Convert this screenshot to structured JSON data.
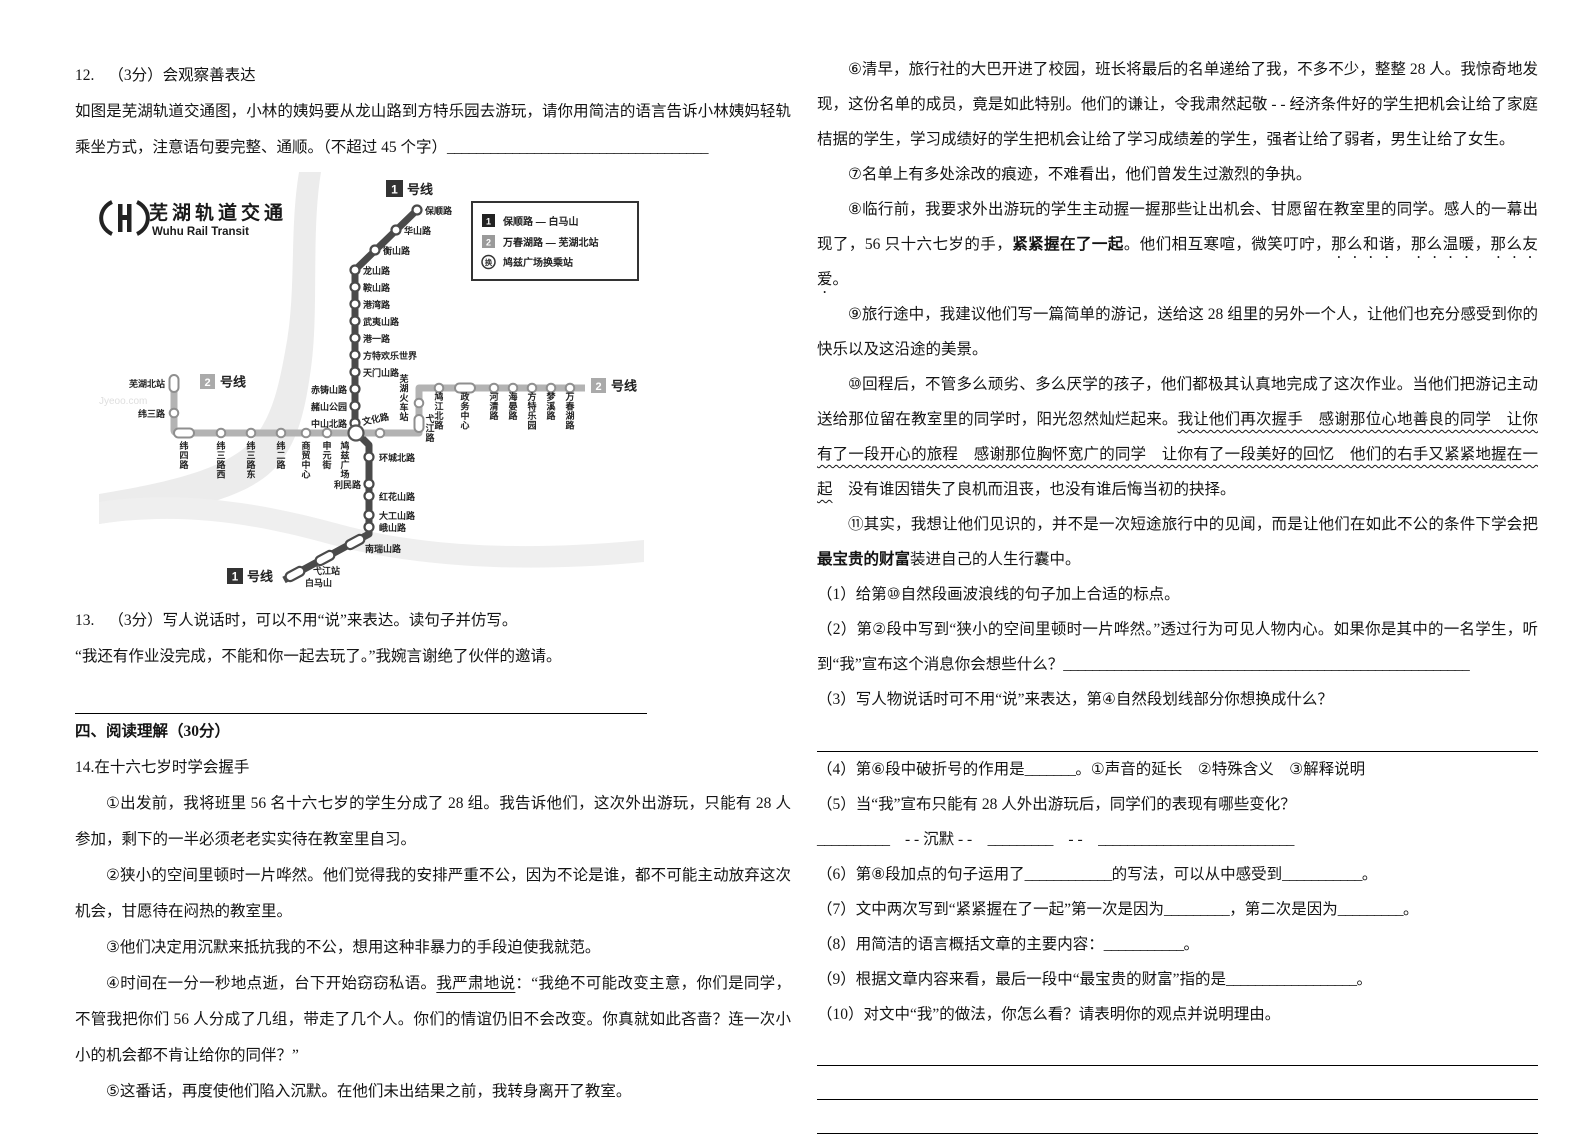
{
  "q12": {
    "label": "12.",
    "score": "（3分）",
    "title": "会观察善表达",
    "body": [
      {
        "t": "如图是芜湖轨道交通图，小林的姨妈要从龙山路到方特乐园去游玩，请你用简洁的语言告诉小林姨妈轻轨乘坐方式，注意语句要完整、通顺。（不超过 45 个字）"
      },
      {
        "t": "____________________________________",
        "s": "blank"
      }
    ]
  },
  "map": {
    "logo": {
      "title": "芜湖轨道交通",
      "subtitle": "Wuhu Rail Transit"
    },
    "badges": {
      "one": "1",
      "two": "2",
      "suffix": "号线"
    },
    "legend": [
      {
        "key": "1",
        "label": "保顺路 — 白马山"
      },
      {
        "key": "2",
        "label": "万春湖路 — 芜湖北站"
      },
      {
        "key": "换",
        "label": "鸠兹广场换乘站"
      }
    ],
    "line1": [
      "保顺路",
      "华山路",
      "衡山路",
      "龙山路",
      "鞍山路",
      "港湾路",
      "武夷山路",
      "港一路",
      "方特欢乐世界",
      "天门山路",
      "赤铸山路",
      "赭山公园",
      "中山北路",
      "环城北路",
      "利民路",
      "红花山路",
      "大工山路",
      "峨山路",
      "南瑞山路",
      "弋江站",
      "白马山"
    ],
    "line2": [
      "芜湖北站",
      "纬三路",
      "纬四路",
      "纬三路西",
      "纬三路东",
      "纬二路",
      "商贸中心",
      "申元街",
      "鸠兹广场",
      "文化路",
      "弋江路",
      "芜湖火车站",
      "鸠江北路",
      "政务中心",
      "河清路",
      "海晏路",
      "方特乐园",
      "梦溪路",
      "万春湖路"
    ],
    "watermark": "Jyeoo.com"
  },
  "q13": {
    "label": "13.",
    "score": "（3分）",
    "text": "写人说话时，可以不用“说”来表达。读句子并仿写。",
    "quote": "“我还有作业没完成，不能和你一起去玩了。”我婉言谢绝了伙伴的邀请。"
  },
  "section4": "四、阅读理解（30分）",
  "passage": {
    "title": "14.在十六七岁时学会握手",
    "left": [
      [
        {
          "t": "①出发前，我将班里 56 名十六七岁的学生分成了 28 组。我告诉他们，这次外出游玩，只能有 28 人参加，剩下的一半必须老老实实待在教室里自习。"
        }
      ],
      [
        {
          "t": "②狭小的空间里顿时一片哗然。他们觉得我的安排严重不公，因为不论是谁，都不可能主动放弃这次机会，甘愿待在闷热的教室里。"
        }
      ],
      [
        {
          "t": "③他们决定用沉默来抵抗我的不公，想用这种非暴力的手段迫使我就范。"
        }
      ],
      [
        {
          "t": "④时间在一分一秒地点逝，台下开始窃窃私语。"
        },
        {
          "t": "我严肃地说",
          "s": "u"
        },
        {
          "t": "：“我绝不可能改变主意，你们是同学，不管我把你们 56 人分成了几组，带走了几个人。你们的情谊仍旧不会改变。你真就如此吝啬？连一次小小的机会都不肯让给你的同伴？”"
        }
      ],
      [
        {
          "t": "⑤这番话，再度使他们陷入沉默。在他们未出结果之前，我转身离开了教室。"
        }
      ]
    ],
    "right": [
      [
        {
          "t": "⑥清早，旅行社的大巴开进了校园，班长将最后的名单递给了我，不多不少，整整 28 人。我惊奇地发现，这份名单的成员，竟是如此特别。他们的谦让，令我肃然起敬 - - 经济条件好的学生把机会让给了家庭桔据的学生，学习成绩好的学生把机会让给了学习成绩差的学生，强者让给了弱者，男生让给了女生。"
        }
      ],
      [
        {
          "t": "⑦名单上有多处涂改的痕迹，不难看出，他们曾发生过激烈的争执。"
        }
      ],
      [
        {
          "t": "⑧临行前，我要求外出游玩的学生主动握一握那些让出机会、甘愿留在教室里的同学。感人的一幕出现了，56 只十六七岁的手，"
        },
        {
          "t": "紧紧握在了一起",
          "s": "b"
        },
        {
          "t": "。他们相互寒喧，微笑叮咛，"
        },
        {
          "t": "那么和谐",
          "s": "dot"
        },
        {
          "t": "，"
        },
        {
          "t": "那么温暖",
          "s": "dot"
        },
        {
          "t": "，"
        },
        {
          "t": "那么友爱",
          "s": "dot"
        },
        {
          "t": "。"
        }
      ],
      [
        {
          "t": "⑨旅行途中，我建议他们写一篇简单的游记，送给这 28 组里的另外一个人，让他们也充分感受到你的快乐以及这沿途的美景。"
        }
      ],
      [
        {
          "t": "⑩回程后，不管多么顽劣、多么厌学的孩子，他们都极其认真地完成了这次作业。当他们把游记主动送给那位留在教室里的同学时，阳光忽然灿烂起来。"
        },
        {
          "t": "我让他们再次握手　感谢那位心地善良的同学　让你有了一段开心的旅程　感谢那位胸怀宽广的同学　让你有了一段美好的回忆　他们的右手又紧紧地握在一起",
          "s": "wavy"
        },
        {
          "t": "　没有谁因错失了良机而沮丧，也没有谁后悔当初的抉择。"
        }
      ],
      [
        {
          "t": "⑪其实，我想让他们见识的，并不是一次短途旅行中的见闻，而是让他们在如此不公的条件下学会把"
        },
        {
          "t": "最宝贵的财富",
          "s": "b"
        },
        {
          "t": "装进自己的人生行囊中。"
        }
      ]
    ]
  },
  "questions": {
    "q1": [
      {
        "t": "（1）给第⑩自然段画波浪线的句子加上合适的标点。"
      }
    ],
    "q2": [
      {
        "t": "（2）第②段中写到“狭小的空间里顿时一片哗然。”透过行为可见人物内心。如果你是其中的一名学生，听到“我”宣布这个消息你会想些什么？"
      },
      {
        "t": "________________________________________________________",
        "s": "blank"
      }
    ],
    "q3": [
      {
        "t": "（3）写人物说话时可不用“说”来表达，第④自然段划线部分你想换成什么？"
      }
    ],
    "q4": [
      {
        "t": "（4）第⑥段中破折号的作用是"
      },
      {
        "t": "_______",
        "s": "blank"
      },
      {
        "t": "。①声音的延长　②特殊含义　③解释说明"
      }
    ],
    "q5": [
      {
        "t": "（5）当“我”宣布只能有 28 人外出游玩后，同学们的表现有哪些变化？"
      }
    ],
    "q5b": [
      {
        "t": "__________",
        "s": "blank"
      },
      {
        "t": "　- - 沉默 - -　"
      },
      {
        "t": "_________",
        "s": "blank"
      },
      {
        "t": "　- -　"
      },
      {
        "t": "___________________________",
        "s": "blank"
      }
    ],
    "q6": [
      {
        "t": "（6）第⑧段加点的句子运用了"
      },
      {
        "t": "____________",
        "s": "blank"
      },
      {
        "t": "的写法，可以从中感受到"
      },
      {
        "t": "___________",
        "s": "blank"
      },
      {
        "t": "。"
      }
    ],
    "q7": [
      {
        "t": "（7）文中两次写到“紧紧握在了一起”第一次是因为"
      },
      {
        "t": "_________",
        "s": "blank"
      },
      {
        "t": "，第二次是因为"
      },
      {
        "t": "_________",
        "s": "blank"
      },
      {
        "t": "。"
      }
    ],
    "q8": [
      {
        "t": "（8）用简洁的语言概括文章的主要内容："
      },
      {
        "t": "___________",
        "s": "blank"
      },
      {
        "t": "。"
      }
    ],
    "q9": [
      {
        "t": "（9）根据文章内容来看，最后一段中“最宝贵的财富”指的是"
      },
      {
        "t": "__________________",
        "s": "blank"
      },
      {
        "t": "。"
      }
    ],
    "q10": [
      {
        "t": "（10）对文中“我”的做法，你怎么看？请表明你的观点并说明理由。"
      }
    ]
  }
}
